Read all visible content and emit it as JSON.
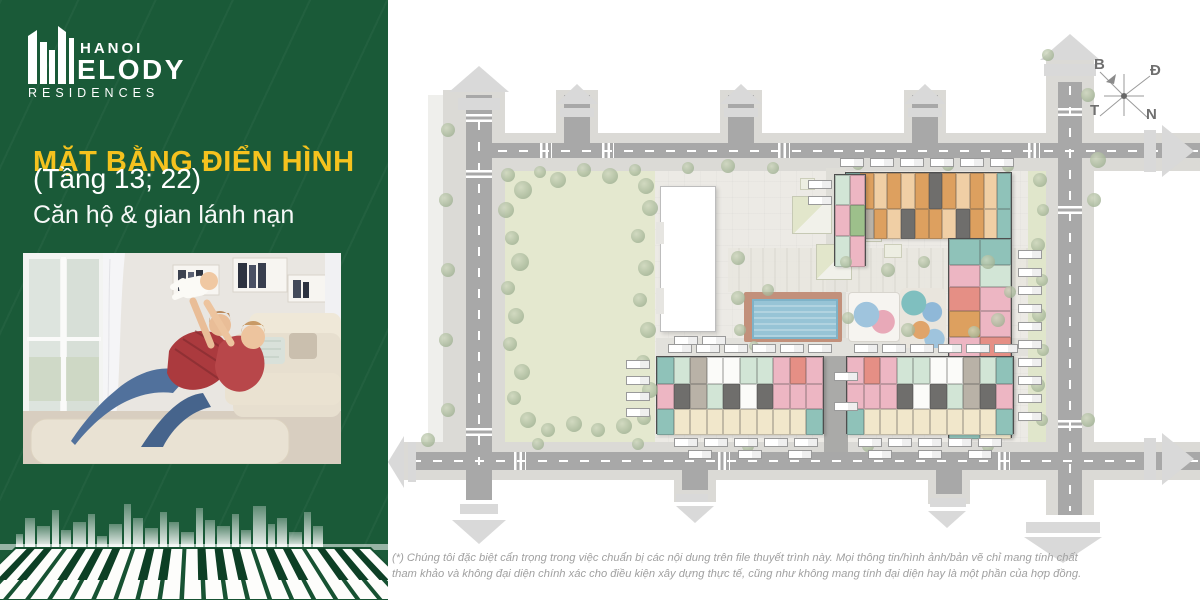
{
  "brand": {
    "line1": "HANOI",
    "line2": "ELODY",
    "line3": "RESIDENCES"
  },
  "panel": {
    "title": "MẶT BẰNG ĐIỂN HÌNH",
    "subtitle": "(Tầng 13; 22)",
    "description": "Căn hộ & gian lánh nạn",
    "colors": {
      "background_green": "#1A5A38",
      "accent_yellow": "#F5C21E",
      "text": "#FFFFFF"
    }
  },
  "plan": {
    "compass": {
      "north_label": "B",
      "east_label": "Đ",
      "west_label": "T",
      "south_label": "N"
    },
    "pool_color": "#97C4D6",
    "park_color": "#E4E8CF",
    "road_color": "#A8A8A8"
  },
  "footer": {
    "disclaimer": "(*) Chúng tôi đặc biệt cẩn trọng trong việc chuẩn bị các nội dung trên file thuyết trình này. Mọi thông tin/hình ảnh/bản vẽ chỉ mang tính chất tham khảo và không đại diện chính xác cho điều kiện xây dựng thực tế, cũng như không mang tính đại diện hay là một phần của hợp đồng."
  }
}
